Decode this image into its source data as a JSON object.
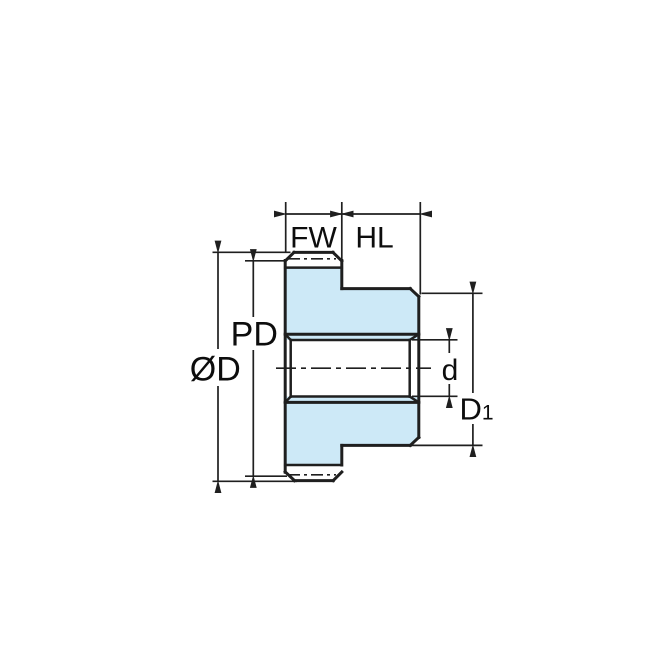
{
  "diagram": {
    "kind": "gear-cross-section-dimension-drawing",
    "labels": {
      "face_width": "FW",
      "hub_length": "HL",
      "pitch_diameter": "PD",
      "outside_diameter": "ØD",
      "bore_diameter": "d",
      "hub_diameter_base": "D",
      "hub_diameter_sub": "1"
    },
    "colors": {
      "gear_fill": "#cde9f7",
      "line": "#1f1f1f",
      "text": "#0d0d0d",
      "background": "#ffffff"
    }
  }
}
